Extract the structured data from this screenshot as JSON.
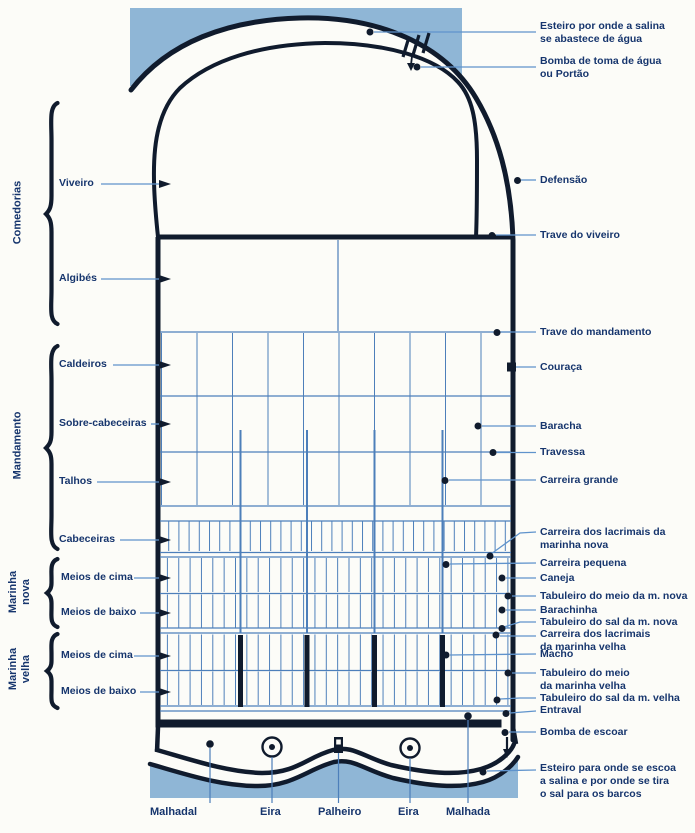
{
  "diagram": {
    "subject": "Plano de uma salina (salt-works plan diagram)",
    "language": "Portuguese"
  },
  "colors": {
    "ink": "#101b2d",
    "label_text": "#16356d",
    "leader_blue": "#4d7fba",
    "grid_blue": "#4d7fba",
    "water_blue": "#8fb6d6",
    "background": "#fcfcf8"
  },
  "left_labels": {
    "comedorias": "Comedorias",
    "viveiro": "Viveiro",
    "algibes": "Algibés",
    "mandamento": "Mandamento",
    "caldeiros": "Caldeiros",
    "sobre_cabeceiras": "Sobre-cabeceiras",
    "talhos": "Talhos",
    "cabeceiras": "Cabeceiras",
    "marinha_nova": "Marinha\nnova",
    "meios_de_cima_nova": "Meios de cima",
    "meios_de_baixo_nova": "Meios de baixo",
    "marinha_velha": "Marinha\nvelha",
    "meios_de_cima_velha": "Meios de cima",
    "meios_de_baixo_velha": "Meios de baixo"
  },
  "right_labels": {
    "esteiro_abastece": "Esteiro por onde a salina\nse abastece de água",
    "bomba_toma": "Bomba de toma de água\nou Portão",
    "defensao": "Defensão",
    "trave_viveiro": "Trave do viveiro",
    "trave_mandamento": "Trave do mandamento",
    "couraca": "Couraça",
    "baracha": "Baracha",
    "travessa": "Travessa",
    "carreira_grande": "Carreira grande",
    "carreira_lacrimais_nova": "Carreira dos lacrimais da\nmarinha nova",
    "carreira_pequena": "Carreira pequena",
    "caneja": "Caneja",
    "tabuleiro_meio_nova": "Tabuleiro do meio da m. nova",
    "barachinha": "Barachinha",
    "tabuleiro_sal_nova": "Tabuleiro do sal da m. nova",
    "carreira_lacrimais_velha": "Carreira dos lacrimais\nda marinha velha",
    "macho": "Macho",
    "tabuleiro_meio_velha": "Tabuleiro do meio\nda marinha velha",
    "tabuleiro_sal_velha": "Tabuleiro do sal da m. velha",
    "entraval": "Entraval",
    "bomba_escoar": "Bomba de escoar",
    "esteiro_escoa": "Esteiro para onde se escoa\na salina e por onde se tira\no sal para os barcos"
  },
  "bottom_labels": {
    "malhadal": "Malhadal",
    "eira_1": "Eira",
    "palheiro": "Palheiro",
    "eira_2": "Eira",
    "malhada": "Malhada"
  }
}
